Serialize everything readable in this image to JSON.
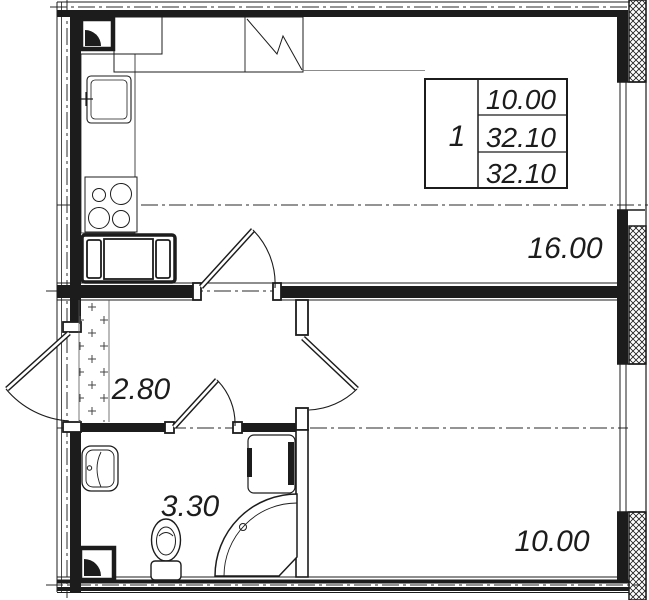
{
  "title": "Apartment floor plan",
  "info_table": {
    "rooms_count": "1",
    "living_area": "10.00",
    "total_area": "32.10",
    "total_area_with_balcony": "32.10"
  },
  "rooms": {
    "living_room": {
      "area": "16.00"
    },
    "hallway": {
      "area": "2.80"
    },
    "bathroom": {
      "area": "3.30"
    },
    "bedroom": {
      "area": "10.00"
    }
  },
  "colors": {
    "line": "#1c1c1c",
    "background": "#ffffff"
  }
}
